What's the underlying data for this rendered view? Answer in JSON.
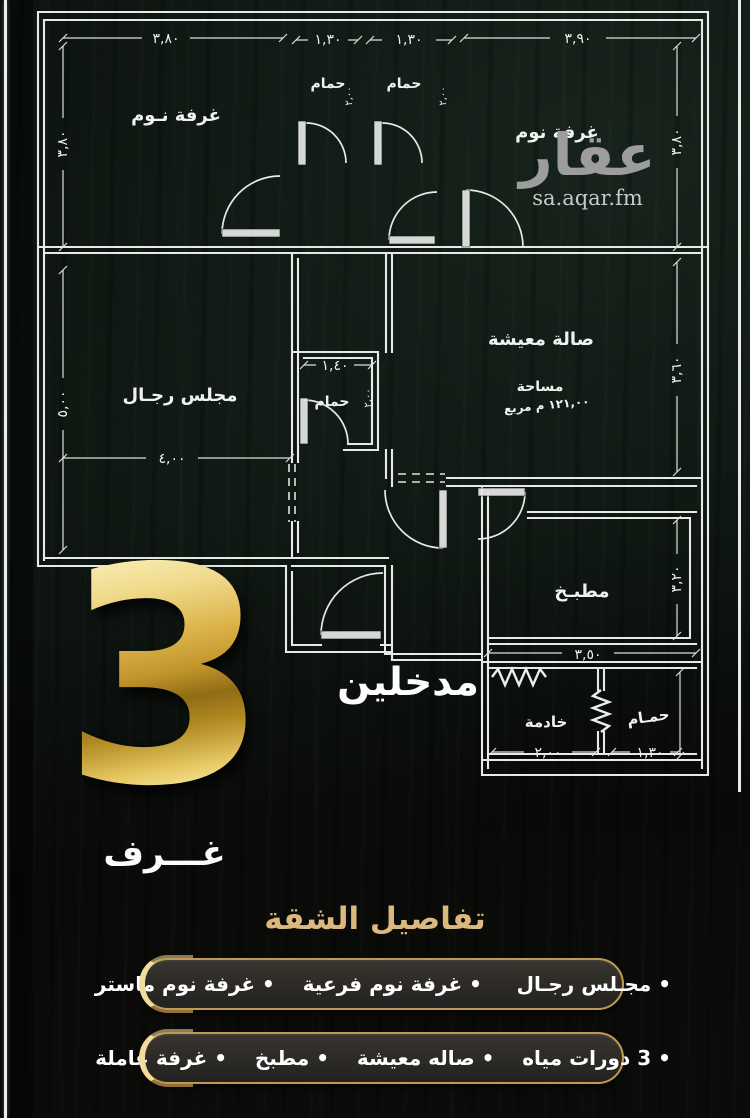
{
  "logo": {
    "name": "عقار",
    "site": "sa.aqar.fm"
  },
  "plan": {
    "rooms": {
      "bedroom1": "غرفة نـوم",
      "bath1": "حمام",
      "bath2": "حمام",
      "bedroom2": "غرفة نوم",
      "majlis": "مجلس رجـال",
      "midbath": "حمام",
      "living": "صالة معيشة",
      "area_label": "مساحة",
      "area_value": "١٢١,٠٠ م مربع",
      "kitchen": "مطبـخ",
      "maid": "خادمة",
      "bath4": "حمـام"
    },
    "dims": {
      "bedroom1_w": "٣,٨٠",
      "bedroom1_h": "٣,٨٠",
      "bath1_w": "١,٣٠",
      "bath1_d": "٢,٠٠",
      "bath2_w": "١,٣٠",
      "bath2_d": "٢,٠٠",
      "bedroom2_w": "٣,٩٠",
      "bedroom2_h": "٣,٨٠",
      "majlis_w": "٤,٠٠",
      "majlis_h": "٥,٠٠",
      "midbath_w": "١,٤٠",
      "midbath_d": "٢,٠٠",
      "living_h": "٣,٦٠",
      "kitchen_w": "٣,٥٠",
      "kitchen_h": "٣,٢٠",
      "maid_w": "٢,٠٠",
      "bath4_w": "١,٣٠"
    },
    "entrances_label": "مدخلين"
  },
  "badge": {
    "number": "3",
    "label": "غـــرف"
  },
  "details": {
    "title": "تفاصيل الشقة",
    "line1": "• مجـلس رجـال     • غرفة نوم فرعية    • غرفة نوم ماستر",
    "line2": "• 3 دورات مياه    • صاله معيشة    • مطبخ    • غرفة عاملة"
  },
  "colors": {
    "gold_border": "#c09a55",
    "crescent": "#f3dca0",
    "title_gold": "#dbb97e",
    "wall_line": "#e6e9e6"
  }
}
